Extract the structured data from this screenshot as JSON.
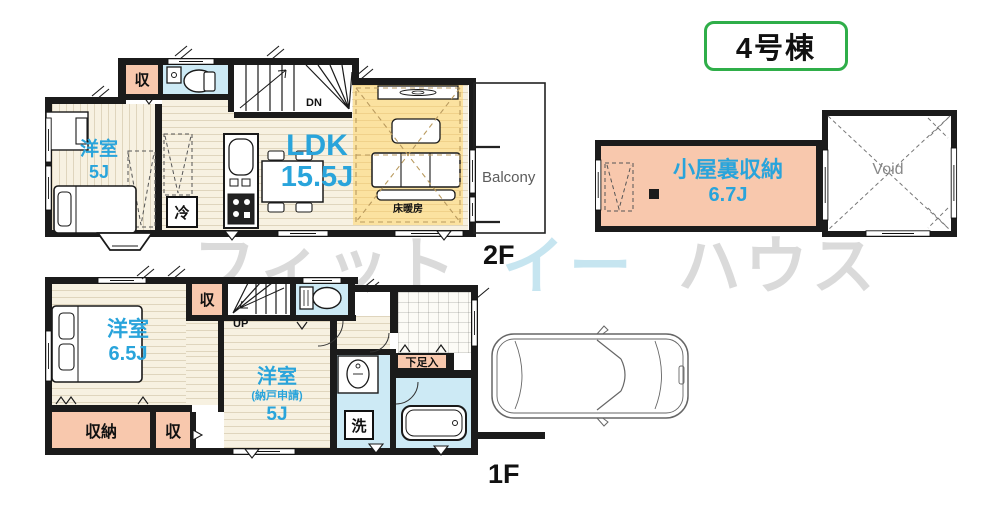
{
  "badge": "4号棟",
  "watermark": {
    "p1": "フィット",
    "p2": "イー",
    "p3": "ハウス"
  },
  "floor2": {
    "label": "2F",
    "bedroom": {
      "name": "洋室",
      "size": "5J"
    },
    "ldk": {
      "name": "LDK",
      "size": "15.5J"
    },
    "heating": "床暖房",
    "closet": "収",
    "fridge": "冷",
    "stairs": "DN",
    "balcony": "Balcony"
  },
  "attic": {
    "name": "小屋裏収納",
    "size": "6.7J",
    "void": "Void"
  },
  "floor1": {
    "label": "1F",
    "bedroom": {
      "name": "洋室",
      "size": "6.5J"
    },
    "bedroom2": {
      "name": "洋室",
      "note": "(納戸申請)",
      "size": "5J"
    },
    "closet_top": "収",
    "closet_main": "収納",
    "closet_small": "収",
    "stairs": "UP",
    "laundry": "洗",
    "shoe": "下足入"
  },
  "colors": {
    "accent_blue": "#29a4db",
    "badge_green": "#2fae49",
    "closet_pink": "#f8c8ad",
    "wet_area_blue": "#cdeaf5",
    "floor_heating_yellow": "#fbe2a0"
  }
}
